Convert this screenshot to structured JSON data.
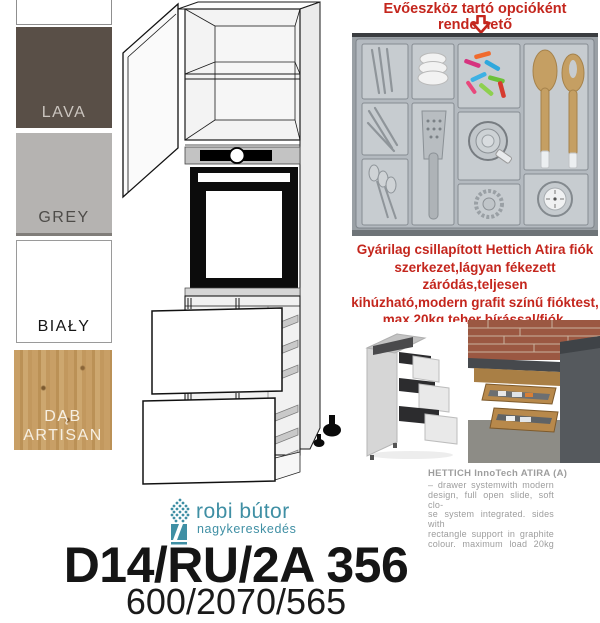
{
  "product": {
    "code": "D14/RU/2A 356",
    "dimensions": "600/2070/565"
  },
  "brand": {
    "name": "robi bútor",
    "tagline": "nagykereskedés",
    "color": "#3f8fa4"
  },
  "swatches": [
    {
      "label": "LAVA",
      "color": "#594f47"
    },
    {
      "label": "GREY",
      "color": "#b5b3b1"
    },
    {
      "label": "BIAŁY",
      "color": "#ffffff"
    },
    {
      "label": "DĄB ARTISAN",
      "color": "#c89f66"
    }
  ],
  "notes": {
    "option_note": "Evőeszköz tartó opcióként rendelhető",
    "drawer_note": "Gyárilag csillapított Hettich Atira fiók\nszerkezet,lágyan fékezett záródás,teljesen\nkihúzható,modern grafit színű fióktest,\nmax.20kg teher bírással/fiók.",
    "accent_color": "#c4261d"
  },
  "hettich_info": {
    "title": "HETTICH InnoTech ATIRA (A)",
    "body": "– drawer systemwith modern\ndesign, full open slide, soft clo-\nse system integrated. sides with\nrectangle support in graphite\ncolour. maximum load 20kg"
  }
}
